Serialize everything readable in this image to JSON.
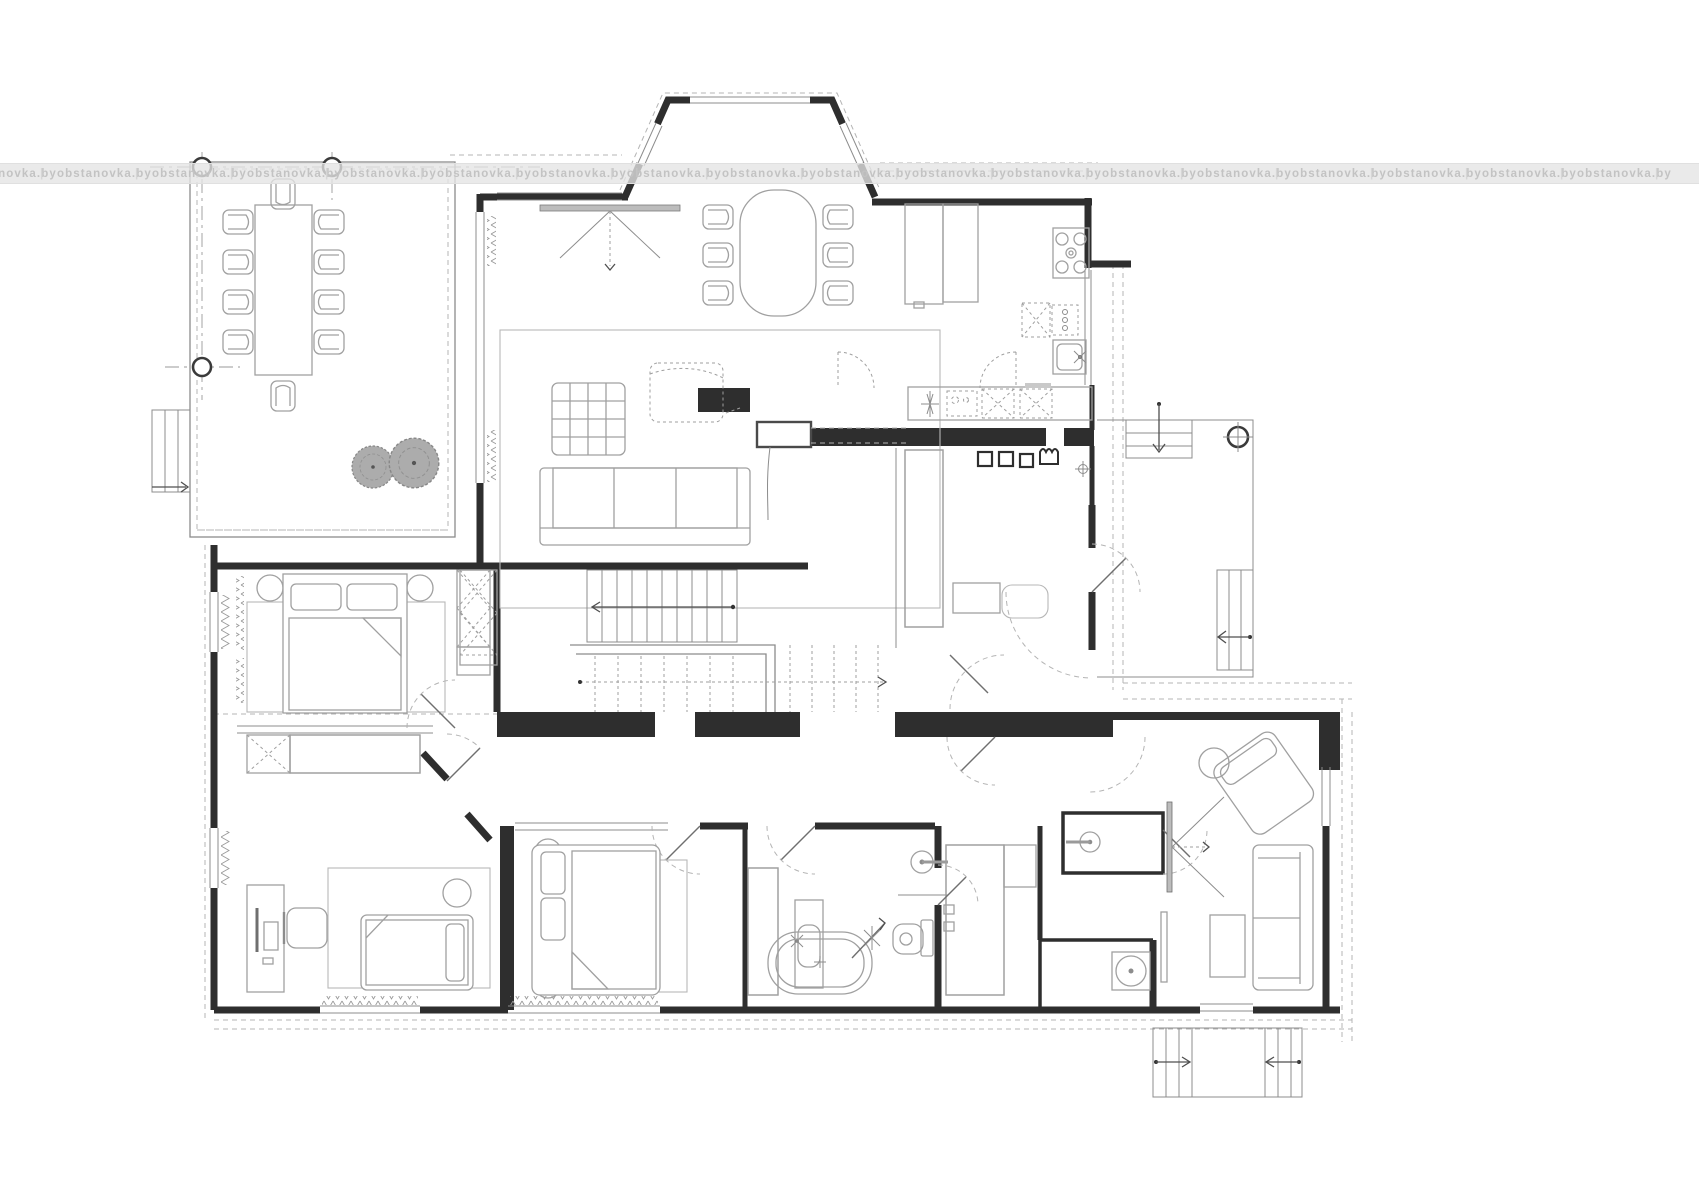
{
  "canvas": {
    "width_px": 1699,
    "height_px": 1200,
    "background": "#ffffff"
  },
  "watermark": {
    "text": "obstanovka.by",
    "separator": "|",
    "repeats": 18,
    "spacing_px": 95,
    "offset_px": -38,
    "band_top_px": 163,
    "band_height_px": 19,
    "band_color": "rgba(228,228,228,0.78)",
    "text_color": "#c3c3c3",
    "separator_color": "#d6d6d6"
  },
  "palette": {
    "wall": "#2e2e2e",
    "thin_line": "#8c8c8c",
    "furniture_line": "#a0a0a0",
    "dashed_line": "#b4b4b4",
    "tree_fill": "#acacac",
    "tree_edge": "#878787",
    "tv_fill": "#bcbcbc"
  },
  "plan": {
    "type": "architectural-floor-plan",
    "label": "country house ground floor plan",
    "rooms": [
      {
        "name": "terrace",
        "features": [
          "dining-table",
          "ten-chairs",
          "three-columns",
          "two-trees",
          "garden-steps"
        ]
      },
      {
        "name": "living-room",
        "features": [
          "tv-console",
          "rug",
          "coffee-table",
          "armchair",
          "sofa",
          "floor-lamp"
        ]
      },
      {
        "name": "dining-area",
        "features": [
          "bay-window",
          "oval-table",
          "six-chairs"
        ]
      },
      {
        "name": "kitchen",
        "features": [
          "tall-cabinets",
          "cooktop",
          "sink",
          "counter",
          "appliances"
        ]
      },
      {
        "name": "entry-hall",
        "features": [
          "wardrobe",
          "bench",
          "rug",
          "entry-door"
        ]
      },
      {
        "name": "entrance-porch",
        "features": [
          "column",
          "steps-up",
          "steps-side"
        ]
      },
      {
        "name": "staircase-hall",
        "features": [
          "stair-up",
          "stair-down",
          "wardrobe"
        ]
      },
      {
        "name": "corridor",
        "features": []
      },
      {
        "name": "master-bedroom",
        "features": [
          "double-bed",
          "nightstands",
          "rug",
          "wardrobe"
        ]
      },
      {
        "name": "kids-room",
        "features": [
          "desk",
          "monitor",
          "chair",
          "single-bed",
          "pouf",
          "rug",
          "wardrobe"
        ]
      },
      {
        "name": "bedroom-2",
        "features": [
          "double-bed",
          "nightstands",
          "rug",
          "closet"
        ]
      },
      {
        "name": "bathroom",
        "features": [
          "washbasin",
          "toilet",
          "shower",
          "bathtub",
          "linen-closet"
        ]
      },
      {
        "name": "sauna",
        "features": [
          "benches",
          "heater"
        ]
      },
      {
        "name": "shower-room",
        "features": [
          "shower-head"
        ]
      },
      {
        "name": "lounge",
        "features": [
          "sofa",
          "coffee-table",
          "chaise",
          "side-table",
          "wall-tv",
          "garden-steps"
        ]
      }
    ]
  }
}
